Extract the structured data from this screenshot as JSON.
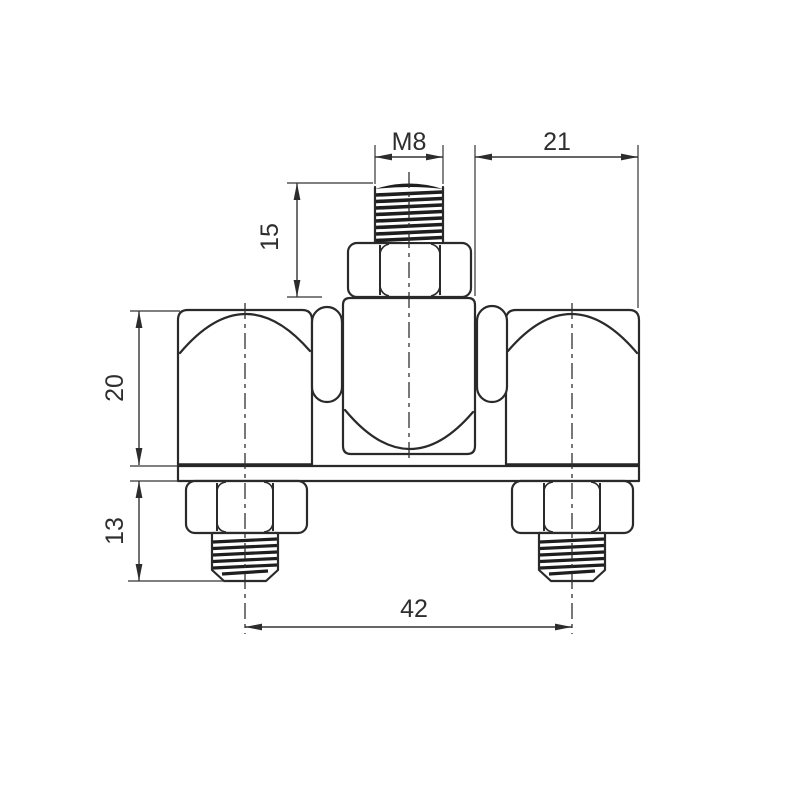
{
  "drawing": {
    "view": "front",
    "background": "#ffffff",
    "line_color": "#2a2a2a",
    "text_color": "#2e2e2e",
    "dimensions": {
      "thread_size": "M8",
      "right_offset": "21",
      "top_stud_length": "15",
      "body_height": "20",
      "bottom_stud_length": "13",
      "stud_spacing": "42"
    }
  }
}
